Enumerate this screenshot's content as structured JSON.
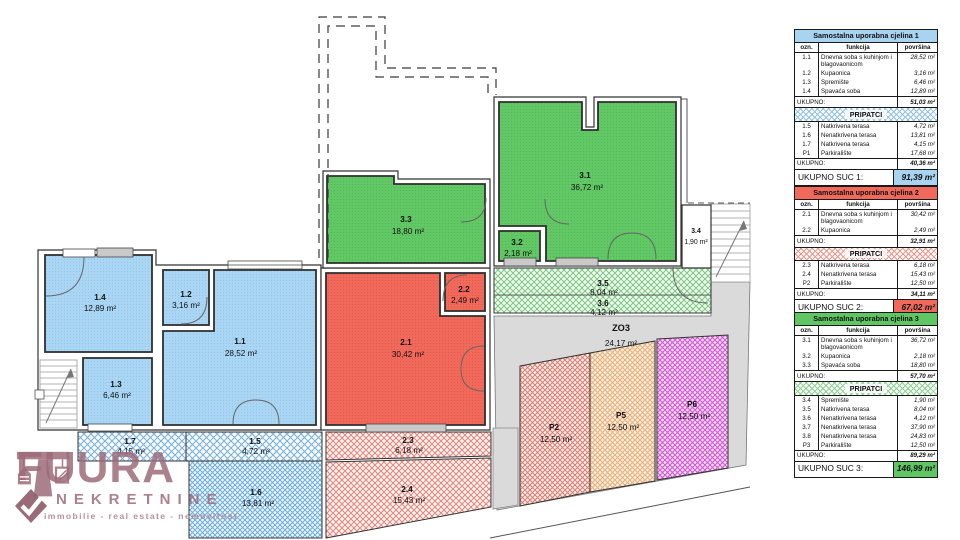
{
  "plan": {
    "labels": {
      "r11": {
        "code": "1.1",
        "area": "28,52 m²"
      },
      "r12": {
        "code": "1.2",
        "area": "3,16 m²"
      },
      "r13": {
        "code": "1.3",
        "area": "6,46 m²"
      },
      "r14": {
        "code": "1.4",
        "area": "12,89 m²"
      },
      "r15": {
        "code": "1.5",
        "area": "4,72 m²"
      },
      "r16": {
        "code": "1.6",
        "area": "13,81 m²"
      },
      "r17": {
        "code": "1.7",
        "area": "4,15 m²"
      },
      "r21": {
        "code": "2.1",
        "area": "30,42 m²"
      },
      "r22": {
        "code": "2.2",
        "area": "2,49 m²"
      },
      "r23": {
        "code": "2.3",
        "area": "6,18 m²"
      },
      "r24": {
        "code": "2.4",
        "area": "15,43 m²"
      },
      "r31": {
        "code": "3.1",
        "area": "36,72 m²"
      },
      "r32": {
        "code": "3.2",
        "area": "2,18 m²"
      },
      "r33": {
        "code": "3.3",
        "area": "18,80 m²"
      },
      "r34": {
        "code": "3.4",
        "area": "1,90 m²"
      },
      "r35": {
        "code": "3.5",
        "area": "8,04 m²"
      },
      "r36": {
        "code": "3.6",
        "area": "4,12 m²"
      },
      "zo3": {
        "code": "ZO3",
        "area": "24,17 m²"
      },
      "p2": {
        "code": "P2",
        "area": "12,50 m²"
      },
      "p5": {
        "code": "P5",
        "area": "12,50 m²"
      },
      "p6": {
        "code": "P6",
        "area": "12,50 m²"
      }
    }
  },
  "colors": {
    "suc1": "#A8D4F2",
    "suc2": "#F1695B",
    "suc3": "#5FC663",
    "p5_orange": "#E8AF7E",
    "p6_magenta": "#D55BD5",
    "ground_gray": "#DADADA",
    "logo": "#9C6B79"
  },
  "logo": {
    "brand_pre": "FU",
    "brand_post": "URA",
    "subtitle": "NEKRETNINE",
    "tagline": "immobilie - real estate - nemovitost"
  },
  "tables": [
    {
      "title": "Samostalna uporabna cjelina 1",
      "col_ozn": "ozn.",
      "col_funkcija": "funkcija",
      "col_povrsina": "površina",
      "main_rows": [
        {
          "ozn": "1.1",
          "funkcija": "Dnevna soba s kuhinjom i blagovaonicom",
          "povrsina": "28,52 m²"
        },
        {
          "ozn": "1.2",
          "funkcija": "Kupaonica",
          "povrsina": "3,16 m²"
        },
        {
          "ozn": "1.3",
          "funkcija": "Spremište",
          "povrsina": "6,46 m²"
        },
        {
          "ozn": "1.4",
          "funkcija": "Spavaća soba",
          "povrsina": "12,89 m²"
        }
      ],
      "ukupno_label": "UKUPNO:",
      "main_total": "51,03 m²",
      "pripatci_label": "PRIPATCI",
      "pripatci_rows": [
        {
          "ozn": "1.5",
          "funkcija": "Natkrivena terasa",
          "povrsina": "4,72 m²"
        },
        {
          "ozn": "1.6",
          "funkcija": "Nenatkrivena terasa",
          "povrsina": "13,81 m²"
        },
        {
          "ozn": "1.7",
          "funkcija": "Natkrivena terasa",
          "povrsina": "4,15 m²"
        },
        {
          "ozn": "P1",
          "funkcija": "Parkiralište",
          "povrsina": "17,68 m²"
        }
      ],
      "ukupno2_label": "UKUPNO:",
      "pripatci_total": "40,36 m²",
      "total_label": "UKUPNO SUC 1:",
      "total_value": "91,39 m²"
    },
    {
      "title": "Samostalna uporabna cjelina 2",
      "col_ozn": "ozn.",
      "col_funkcija": "funkcija",
      "col_povrsina": "površina",
      "main_rows": [
        {
          "ozn": "2.1",
          "funkcija": "Dnevna soba s kuhinjom i blagovaonicom",
          "povrsina": "30,42 m²"
        },
        {
          "ozn": "2.2",
          "funkcija": "Kupaonica",
          "povrsina": "2,49 m²"
        }
      ],
      "ukupno_label": "UKUPNO:",
      "main_total": "32,91 m²",
      "pripatci_label": "PRIPATCI",
      "pripatci_rows": [
        {
          "ozn": "2.3",
          "funkcija": "Natkrivena terasa",
          "povrsina": "6,18 m²"
        },
        {
          "ozn": "2.4",
          "funkcija": "Nenatkrivena terasa",
          "povrsina": "15,43 m²"
        },
        {
          "ozn": "P2",
          "funkcija": "Parkiralište",
          "povrsina": "12,50 m²"
        }
      ],
      "ukupno2_label": "UKUPNO:",
      "pripatci_total": "34,11 m²",
      "total_label": "UKUPNO SUC 2:",
      "total_value": "67,02 m²"
    },
    {
      "title": "Samostalna uporabna cjelina 3",
      "col_ozn": "ozn.",
      "col_funkcija": "funkcija",
      "col_povrsina": "površina",
      "main_rows": [
        {
          "ozn": "3.1",
          "funkcija": "Dnevna soba s kuhinjom i blagovaonicom",
          "povrsina": "36,72 m²"
        },
        {
          "ozn": "3.2",
          "funkcija": "Kupaonica",
          "povrsina": "2,18 m²"
        },
        {
          "ozn": "3.3",
          "funkcija": "Spavaća soba",
          "povrsina": "18,80 m²"
        }
      ],
      "ukupno_label": "UKUPNO:",
      "main_total": "57,70 m²",
      "pripatci_label": "PRIPATCI",
      "pripatci_rows": [
        {
          "ozn": "3.4",
          "funkcija": "Spremište",
          "povrsina": "1,90 m²"
        },
        {
          "ozn": "3.5",
          "funkcija": "Natkrivena terasa",
          "povrsina": "8,04 m²"
        },
        {
          "ozn": "3.6",
          "funkcija": "Nenatkrivena terasa",
          "povrsina": "4,12 m²"
        },
        {
          "ozn": "3.7",
          "funkcija": "Nenatkrivena terasa",
          "povrsina": "37,90 m²"
        },
        {
          "ozn": "3.8",
          "funkcija": "Nenatkrivena terasa",
          "povrsina": "24,83 m²"
        },
        {
          "ozn": "P3",
          "funkcija": "Parkiralište",
          "povrsina": "12,50 m²"
        }
      ],
      "ukupno2_label": "UKUPNO:",
      "pripatci_total": "89,29 m²",
      "total_label": "UKUPNO SUC 3:",
      "total_value": "146,99 m²"
    }
  ]
}
